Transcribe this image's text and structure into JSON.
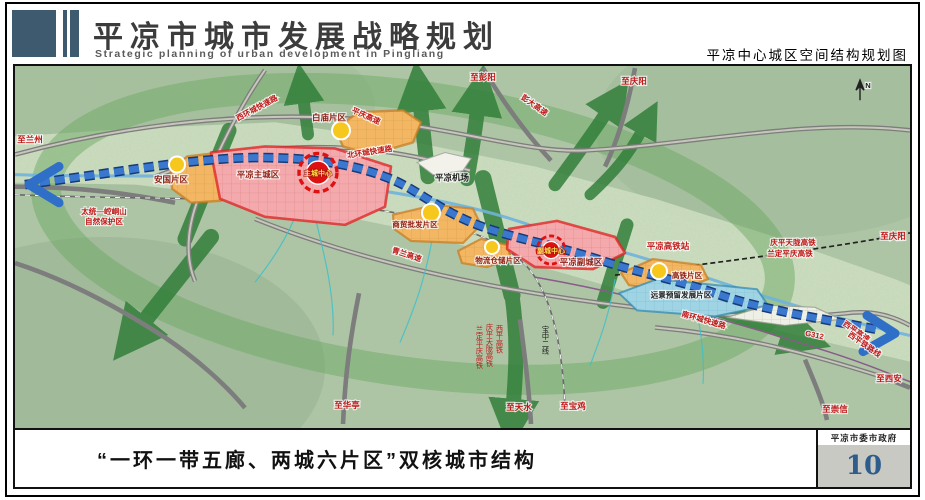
{
  "header": {
    "title": "平凉市城市发展战略规划",
    "subtitle_en": "Strategic planning of urban development in Pingliang",
    "map_title": "平凉中心城区空间结构规划图"
  },
  "footer": {
    "caption": "“一环一带五廊、两城六片区”双核城市结构",
    "gov_label": "平凉市委市政府",
    "page_number": "10"
  },
  "map": {
    "compass": "N",
    "labels": [
      {
        "text": "至兰州"
      },
      {
        "text": "西环城快速路"
      },
      {
        "text": "平庆高速"
      },
      {
        "text": "至彭阳"
      },
      {
        "text": "彭大高速"
      },
      {
        "text": "至庆阳"
      },
      {
        "text": "白庙片区"
      },
      {
        "text": "北环城快速路"
      },
      {
        "text": "平凉机场"
      },
      {
        "text": "安国片区"
      },
      {
        "text": "平凉主城区"
      },
      {
        "text": "主城中心"
      },
      {
        "text": "太统—崆峒山"
      },
      {
        "text": "自然保护区"
      },
      {
        "text": "青兰高速"
      },
      {
        "text": "商贸批发片区"
      },
      {
        "text": "物流仓储片区"
      },
      {
        "text": "副城中心"
      },
      {
        "text": "平凉副城区"
      },
      {
        "text": "平凉高铁站"
      },
      {
        "text": "庆平天陇高铁"
      },
      {
        "text": "兰定平庆高铁"
      },
      {
        "text": "至庆阳"
      },
      {
        "text": "高铁片区"
      },
      {
        "text": "远景预留发展片区"
      },
      {
        "text": "南环城快速路"
      },
      {
        "text": "G312"
      },
      {
        "text": "西平高速"
      },
      {
        "text": "西平铁路线"
      },
      {
        "text": "至西安"
      },
      {
        "text": "至崇信"
      },
      {
        "text": "至华亭"
      },
      {
        "text": "至天水"
      },
      {
        "text": "至宝鸡"
      },
      {
        "text": "宝中二线"
      },
      {
        "text": "西平高铁"
      },
      {
        "text": "庆平天陇高铁"
      },
      {
        "text": "兰定平庆高铁"
      }
    ]
  },
  "colors": {
    "accent_slate": "#3d5a6e",
    "page_number_blue": "#2e5d8c",
    "terrain_green": "#aec6a5",
    "corridor_green": "#2e7d36",
    "belt_blue": "#2f6fc8",
    "city_red": "#e02020",
    "district_orange": "#c77a1e",
    "reserve_blue": "#2f88b0",
    "node_yellow": "#f6c71c"
  }
}
